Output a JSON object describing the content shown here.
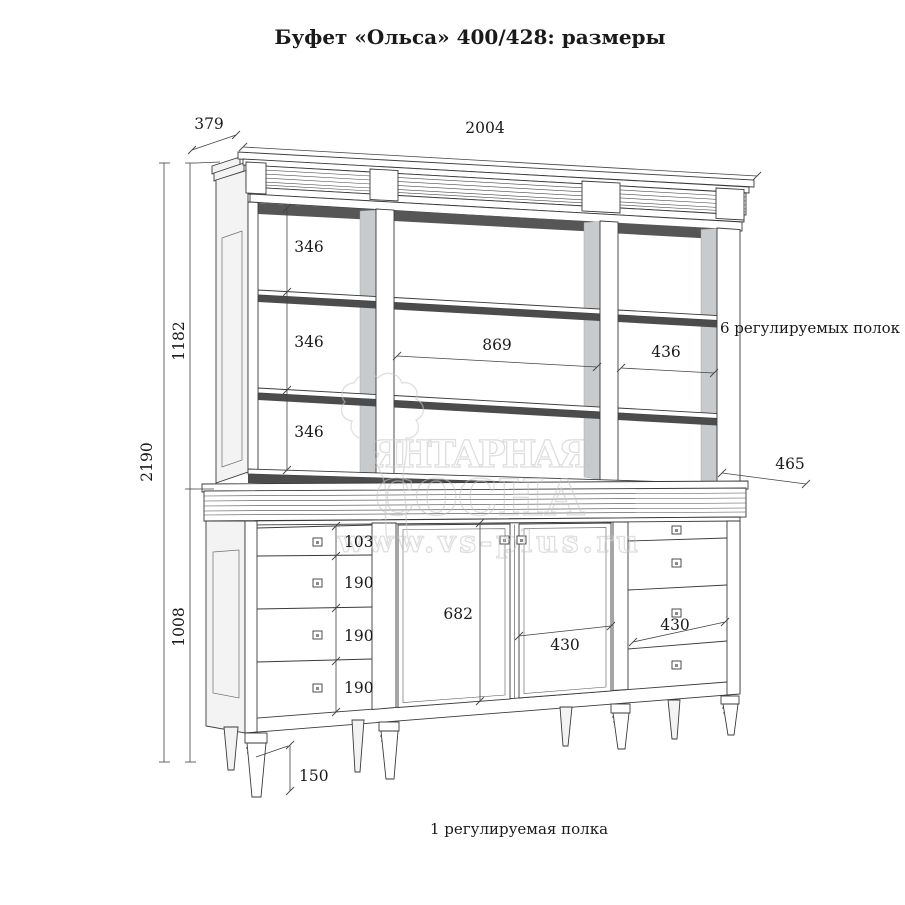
{
  "title": "Буфет «Ольса»  400/428: размеры",
  "dims": {
    "depth_top": "379",
    "width_total": "2004",
    "height_total": "2190",
    "height_hutch": "1182",
    "height_base": "1008",
    "shelf_gaps": [
      "346",
      "346",
      "346"
    ],
    "mid_opening_width": "869",
    "right_opening_width": "436",
    "base_depth": "465",
    "drawer_heights": [
      "103",
      "190",
      "190",
      "190"
    ],
    "door_height": "682",
    "door_width": "430",
    "right_drawer_width": "430",
    "leg_height": "150"
  },
  "annotations": {
    "hutch_shelves": "6 регулируемых полок",
    "base_shelf": "1 регулируемая полка"
  },
  "watermark": {
    "brand_line1": "ЯНТАРНАЯ",
    "brand_line2": "СОСНА",
    "url": "www.vs-plus.ru"
  },
  "colors": {
    "line": "#3a3a3a",
    "shadow": "#565656",
    "inner_wall": "#c8cbcd",
    "watermark": "#c4c4c4"
  }
}
